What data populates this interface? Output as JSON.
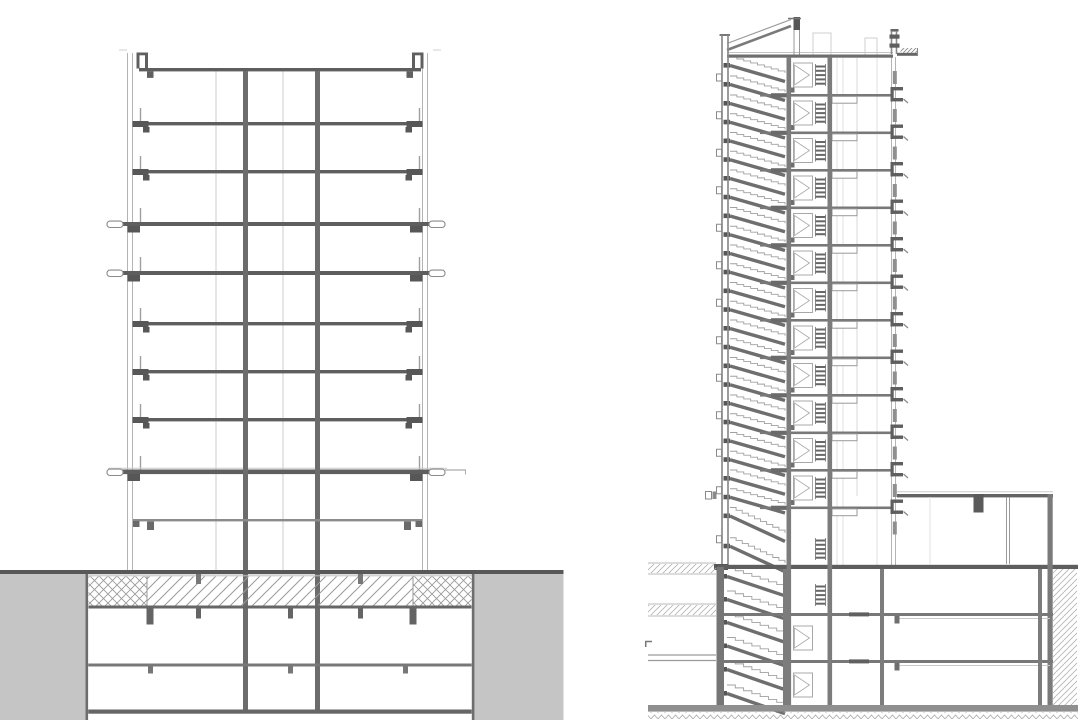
{
  "page": {
    "background": "#ffffff",
    "description": "Two grayscale architectural building section drawings on a white sheet: left, a structural cross-section of a tower on a podium with two basement levels; right, a longitudinal section through the stair and elevator core of a taller tower with three basement levels and a low annex."
  },
  "colors": {
    "slab_strong": "#5e5e5e",
    "slab_mid": "#787878",
    "bracket_dark": "#575757",
    "wall_gray": "#8a8a8a",
    "line_light": "#b4b4b4",
    "line_faint": "#e0e0e0",
    "fill_gray": "#c5c5c5",
    "hatch": "#9a9a9a",
    "soil": "#b3b3b3",
    "white": "#ffffff"
  },
  "left_section": {
    "name": "building-cross-section",
    "stories_above_ground": 10,
    "basement_levels": 2,
    "tower_slabs_y": [
      69,
      122,
      170,
      222,
      271,
      322,
      370,
      418
    ],
    "protruding_slabs_y": [
      222,
      271
    ],
    "canopy_y": 470,
    "podium_slab_y": 519,
    "ground_y": 570,
    "basement_floor_y": 663.5,
    "bottom_slab_y": 709.5,
    "hatch_band_y": [
      576,
      606
    ],
    "facade_left_x": [
      127.5,
      132.5
    ],
    "facade_right_x": [
      422.5,
      427.5
    ],
    "columns_x": [
      245.5,
      317.5
    ],
    "interior_lines_x": [
      216,
      283
    ],
    "slab_span_x": [
      139,
      421
    ],
    "gray_block_left": [
      0,
      86
    ],
    "gray_block_right": [
      474,
      563.5
    ],
    "cross_hatch_zones_x": [
      [
        88.5,
        147
      ],
      [
        413,
        471.5
      ]
    ],
    "diag_hatch_zone_x": [
      147,
      413
    ]
  },
  "right_section": {
    "name": "stair-core-longitudinal-section",
    "stories_above_ground": 13,
    "basement_levels": 3,
    "roof_y": 56,
    "floor_slabs_y": [
      94,
      131.5,
      169,
      206.5,
      244,
      281.5,
      319,
      356.5,
      394,
      431.5,
      469,
      506.5
    ],
    "ground_y": 567,
    "basement_slabs_y": [
      613,
      660
    ],
    "bottom_slab_y": 705,
    "left_wall_x": [
      722,
      728
    ],
    "stair_zone_x": [
      730,
      785
    ],
    "shaft_walls_x": [
      786.5,
      827.5
    ],
    "beam_box_x": [
      832,
      857
    ],
    "facade_x": [
      891.5,
      895.5
    ],
    "interior_lines_x": [
      837,
      843,
      877
    ],
    "annex": {
      "roof_y": 494,
      "roof_span_x": [
        897,
        1053
      ],
      "step_x": 973.5,
      "column_x": 1008,
      "end_wall_x": 1047.5,
      "slabs_y": [
        613,
        660
      ],
      "columns_x": [
        783,
        880,
        1038
      ]
    },
    "soil_left": {
      "x": [
        648,
        716
      ],
      "bands_y": [
        [
          563,
          574
        ],
        [
          604,
          616
        ]
      ],
      "slab_lines_y": [
        655,
        660.5
      ]
    },
    "soil_right": {
      "x": [
        1053,
        1077
      ],
      "y": [
        569,
        705
      ]
    },
    "zigzag_strip_y": 712.5
  }
}
